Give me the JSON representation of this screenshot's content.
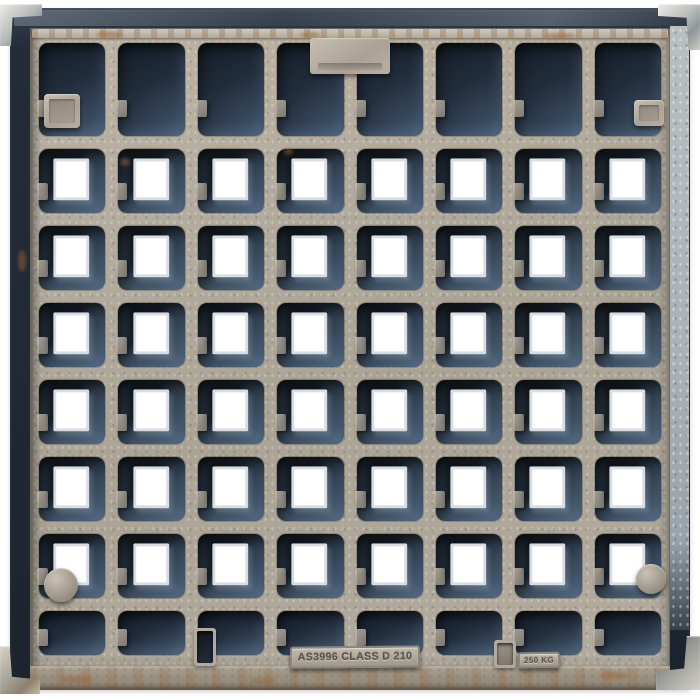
{
  "photo": {
    "subject": "Square cast-iron grate cover with galvanized finish, photographed top-down on white background",
    "background_color": "#ffffff"
  },
  "markings": {
    "standard_plate": "AS3996 CLASS D 210",
    "weight_plate": "250 KG"
  },
  "grate": {
    "grid": {
      "columns": 8,
      "rows": 8,
      "solid_rows": [
        1,
        8
      ],
      "hole_rows": [
        2,
        3,
        4,
        5,
        6,
        7
      ],
      "hole_count": 48
    },
    "colors": {
      "frame_dark": "#232c37",
      "rib_galvanized": "#b3ac9f",
      "cell_recess": "#2b3948",
      "hole": "#ffffff",
      "rust_accent": "#9a6a42",
      "bracket_metal": "#c9cbc7"
    },
    "features": {
      "lifting_tab": "top-center raised tab",
      "corner_brackets": 4,
      "square_bosses": 2,
      "round_bosses": 2,
      "bottom_slots": 2
    }
  }
}
